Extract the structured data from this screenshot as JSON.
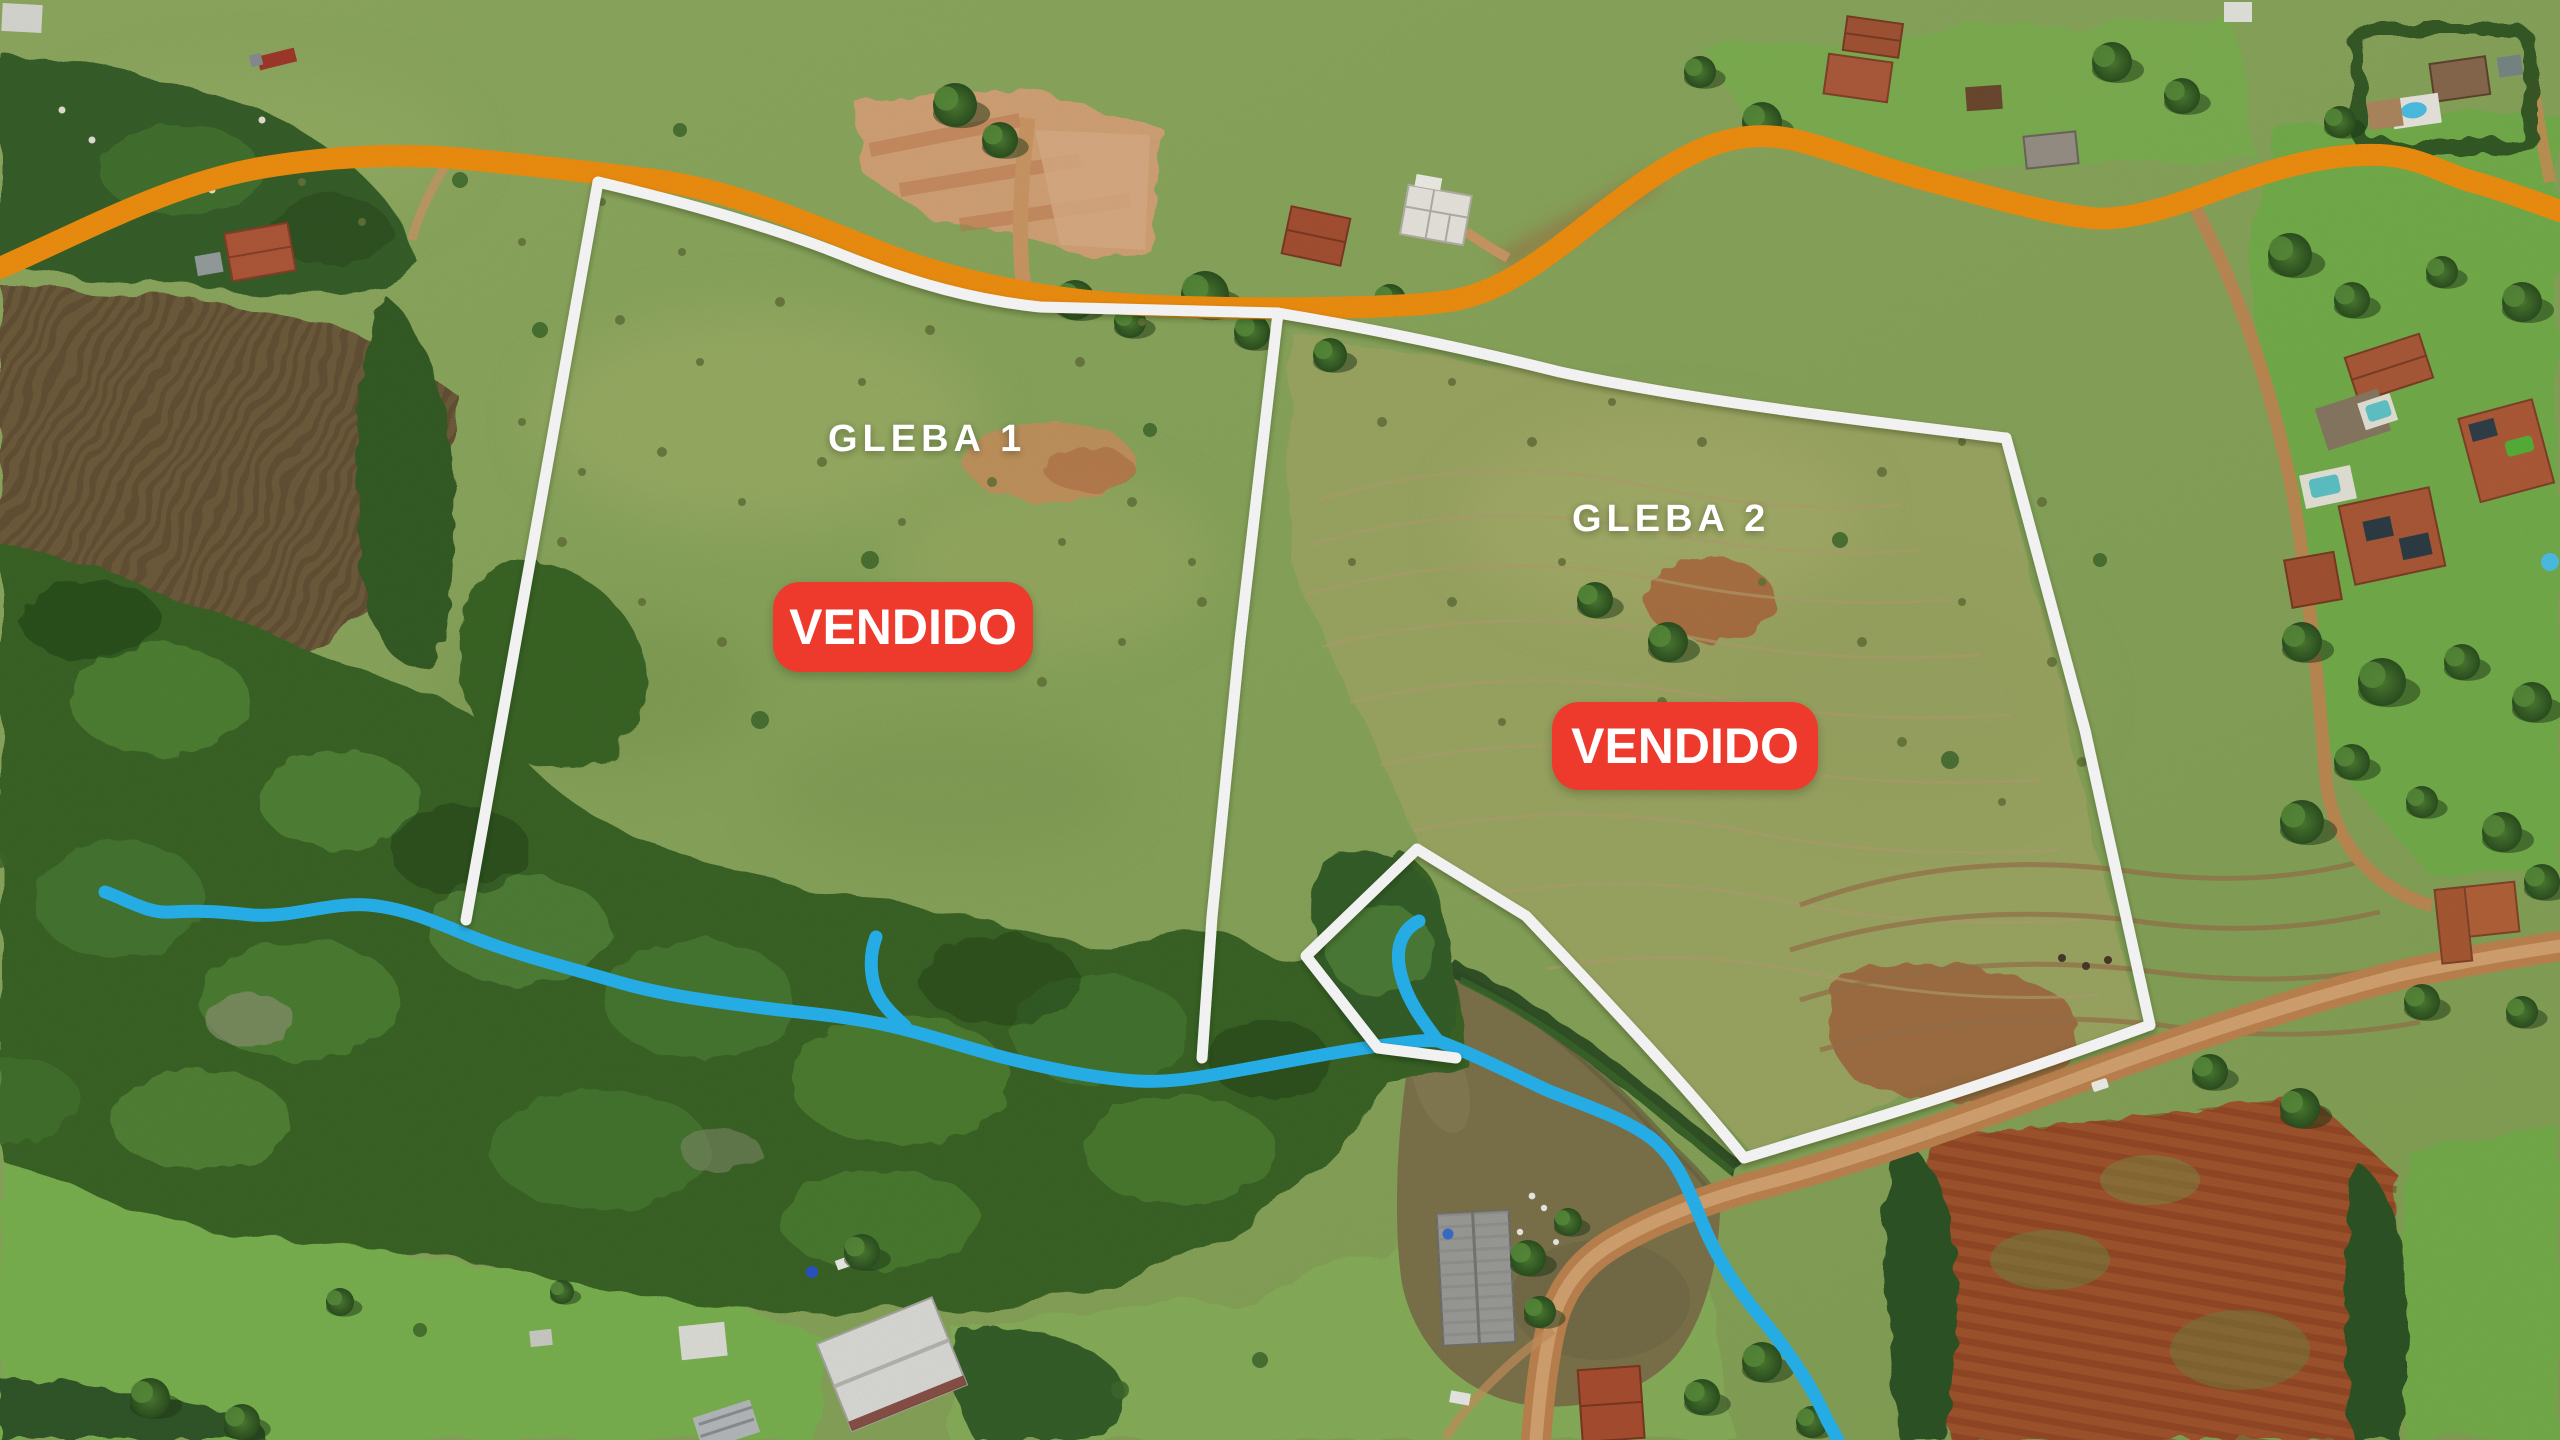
{
  "annotations": {
    "gleba_1_label": "GLEBA 1",
    "gleba_2_label": "GLEBA 2",
    "gleba_1_status": "VENDIDO",
    "gleba_2_status": "VENDIDO"
  },
  "colors": {
    "badge_red": "#EE3A2C",
    "badge_text_white": "#FFFFFF",
    "label_white": "#FFFFFF",
    "boundary_white": "#FFFFFF",
    "road_highlight_orange": "#F39110",
    "stream_blue": "#29B6F2"
  }
}
